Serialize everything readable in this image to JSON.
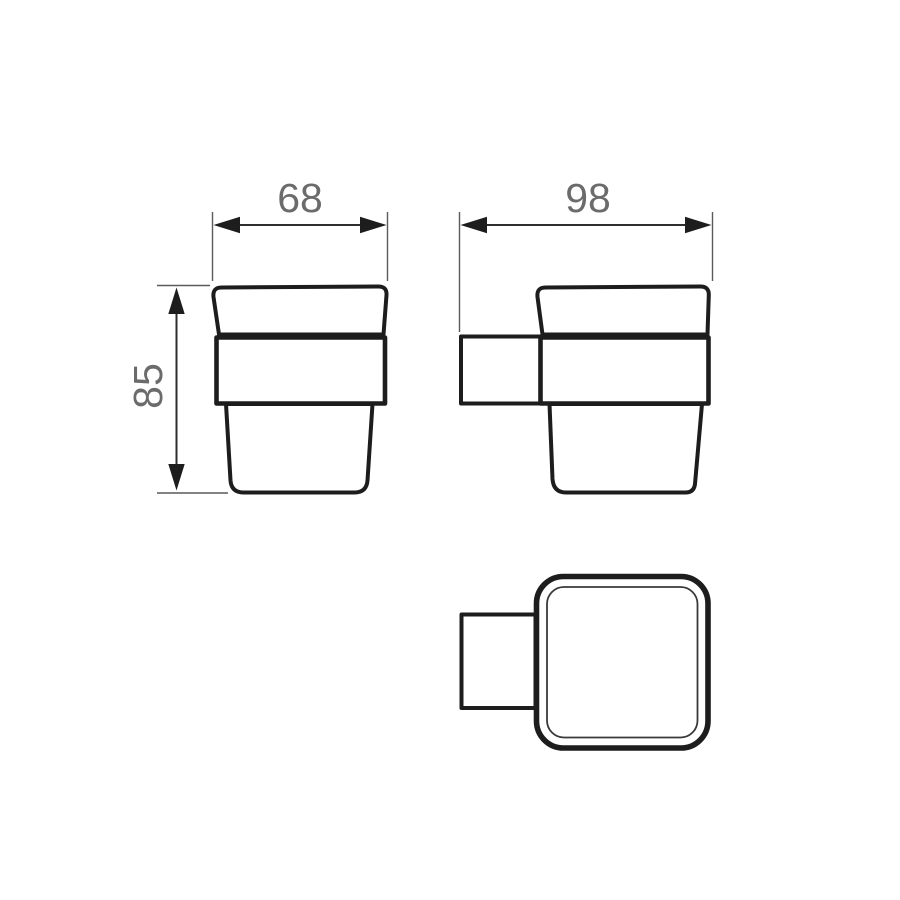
{
  "drawing": {
    "title": "Tumbler holder technical drawing",
    "views": [
      {
        "id": "front-view",
        "description": "front elevation of cup in holder band"
      },
      {
        "id": "side-view",
        "description": "side elevation with wall-mount bracket"
      },
      {
        "id": "top-view",
        "description": "plan view, rounded square cup with bracket"
      }
    ],
    "dimensions": [
      {
        "id": "front-width",
        "value": "68",
        "orientation": "horizontal",
        "view": "front-view"
      },
      {
        "id": "side-depth",
        "value": "98",
        "orientation": "horizontal",
        "view": "side-view"
      },
      {
        "id": "front-height",
        "value": "85",
        "orientation": "vertical",
        "view": "front-view"
      }
    ],
    "colors": {
      "background": "#ffffff",
      "outline": "#1d1d1d",
      "dimension_line": "#2e2e2e",
      "extension_line": "#5a5a5a",
      "dimension_text": "#6b6b6b"
    }
  }
}
